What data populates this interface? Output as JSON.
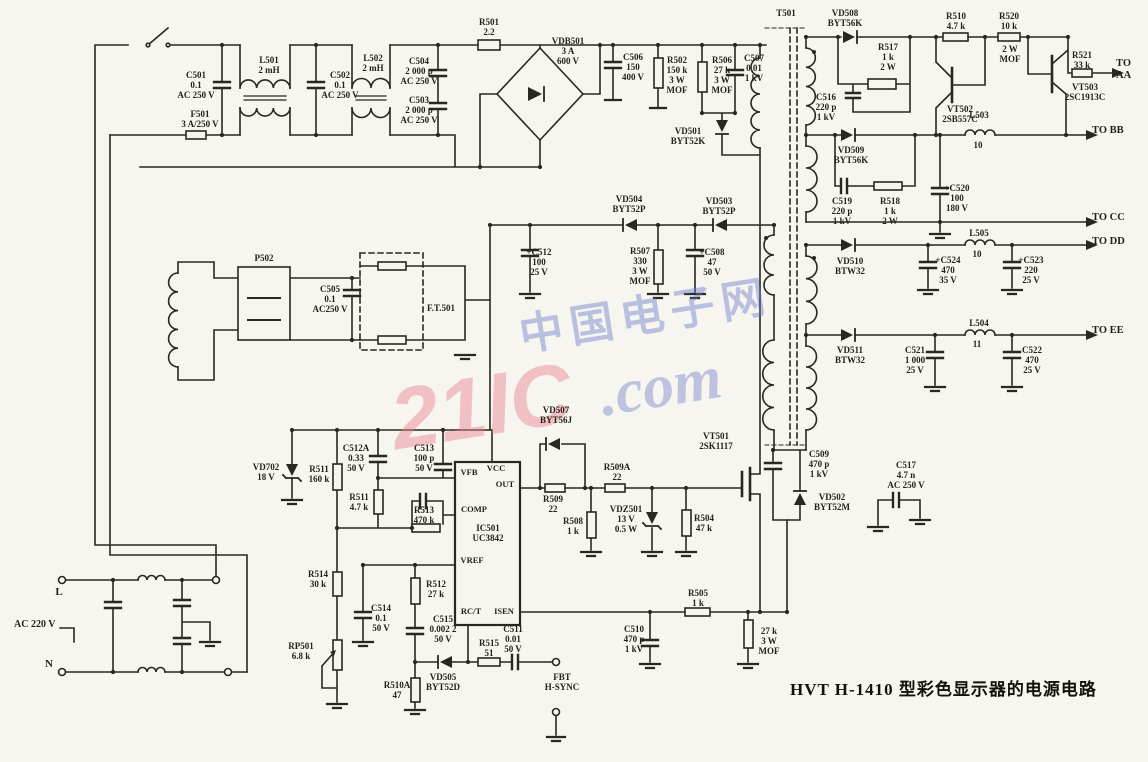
{
  "title": {
    "caption": "HVT H-1410 型彩色显示器的电源电路"
  },
  "watermark": {
    "brand": "21IC",
    "cn": "中国电子网",
    "com": ".com"
  },
  "schematic": {
    "labels": [
      {
        "n": "c501",
        "t": "C501\n0.1\nAC 250 V",
        "x": 196,
        "y": 70
      },
      {
        "n": "f501",
        "t": "F501\n3 A/250 V",
        "x": 200,
        "y": 109
      },
      {
        "n": "l501",
        "t": "L501\n2 mH",
        "x": 269,
        "y": 55
      },
      {
        "n": "c502",
        "t": "C502\n0.1\nAC 250 V",
        "x": 340,
        "y": 70
      },
      {
        "n": "l502",
        "t": "L502\n2 mH",
        "x": 373,
        "y": 53
      },
      {
        "n": "c504",
        "t": "C504\n2 000 p\nAC 250 V",
        "x": 419,
        "y": 56
      },
      {
        "n": "c503",
        "t": "C503\n2 000 p\nAC 250 V",
        "x": 419,
        "y": 95
      },
      {
        "n": "r501",
        "t": "R501\n2.2",
        "x": 489,
        "y": 17
      },
      {
        "n": "vdb501",
        "t": "VDB501\n3 A\n600 V",
        "x": 568,
        "y": 36
      },
      {
        "n": "c506",
        "t": "C506\n150\n400 V",
        "x": 633,
        "y": 52
      },
      {
        "n": "r502",
        "t": "R502\n150 k\n3 W\nMOF",
        "x": 677,
        "y": 55
      },
      {
        "n": "r506",
        "t": "R506\n27 k\n3 W\nMOF",
        "x": 722,
        "y": 55
      },
      {
        "n": "c507",
        "t": "C507\n0.01\n1 kV",
        "x": 754,
        "y": 53
      },
      {
        "n": "vd501",
        "t": "VD501\nBYT52K",
        "x": 688,
        "y": 126
      },
      {
        "n": "t501",
        "t": "T501",
        "x": 786,
        "y": 8
      },
      {
        "n": "vd508",
        "t": "VD508\nBYT56K",
        "x": 845,
        "y": 8
      },
      {
        "n": "r510",
        "t": "R510\n4.7 k",
        "x": 956,
        "y": 11
      },
      {
        "n": "r520",
        "t": "R520\n10 k",
        "x": 1009,
        "y": 11
      },
      {
        "n": "r520-rating",
        "t": "2 W\nMOF",
        "x": 1010,
        "y": 44
      },
      {
        "n": "r517",
        "t": "R517\n1 k\n2 W",
        "x": 888,
        "y": 42
      },
      {
        "n": "c516",
        "t": "C516\n220 p\n1 kV",
        "x": 826,
        "y": 92
      },
      {
        "n": "vt502",
        "t": "VT502\n2SB557C",
        "x": 960,
        "y": 104
      },
      {
        "n": "r521",
        "t": "R521\n33 k",
        "x": 1082,
        "y": 50
      },
      {
        "n": "to-aa",
        "t": "TO AA",
        "x": 1116,
        "y": 58,
        "a": "l",
        "s": 10.5
      },
      {
        "n": "vt503",
        "t": "VT503\n2SC1913C",
        "x": 1085,
        "y": 82
      },
      {
        "n": "l503",
        "t": "L503",
        "x": 979,
        "y": 110
      },
      {
        "n": "l503-val",
        "t": "10",
        "x": 978,
        "y": 140
      },
      {
        "n": "to-bb",
        "t": "TO BB",
        "x": 1092,
        "y": 125,
        "a": "l",
        "s": 10.5
      },
      {
        "n": "vd509",
        "t": "VD509\nBYT56K",
        "x": 851,
        "y": 145
      },
      {
        "n": "c519",
        "t": "C519\n220 p\n1 kV",
        "x": 842,
        "y": 196
      },
      {
        "n": "r518",
        "t": "R518\n1 k\n2 W",
        "x": 890,
        "y": 196
      },
      {
        "n": "c520",
        "t": "+C520\n100\n180 V",
        "x": 957,
        "y": 183
      },
      {
        "n": "to-cc",
        "t": "TO CC",
        "x": 1092,
        "y": 212,
        "a": "l",
        "s": 10.5
      },
      {
        "n": "l505",
        "t": "L505",
        "x": 979,
        "y": 228
      },
      {
        "n": "l505-val",
        "t": "10",
        "x": 977,
        "y": 249
      },
      {
        "n": "to-dd",
        "t": "TO DD",
        "x": 1092,
        "y": 236,
        "a": "l",
        "s": 10.5
      },
      {
        "n": "vd510",
        "t": "VD510\nBTW32",
        "x": 850,
        "y": 256
      },
      {
        "n": "c524",
        "t": "+C524\n470\n35 V",
        "x": 948,
        "y": 255
      },
      {
        "n": "c523",
        "t": "+C523\n220\n25 V",
        "x": 1031,
        "y": 255
      },
      {
        "n": "l504",
        "t": "L504",
        "x": 979,
        "y": 318
      },
      {
        "n": "l504-val",
        "t": "11",
        "x": 977,
        "y": 339
      },
      {
        "n": "to-ee",
        "t": "TO EE",
        "x": 1092,
        "y": 325,
        "a": "l",
        "s": 10.5
      },
      {
        "n": "vd511",
        "t": "VD511\nBTW32",
        "x": 850,
        "y": 345
      },
      {
        "n": "c521",
        "t": "C521\n1 000\n25 V",
        "x": 915,
        "y": 345
      },
      {
        "n": "c522",
        "t": "C522\n470\n25 V",
        "x": 1032,
        "y": 345
      },
      {
        "n": "p502",
        "t": "P502",
        "x": 264,
        "y": 253
      },
      {
        "n": "c505",
        "t": "C505\n0.1\nAC250 V",
        "x": 330,
        "y": 284
      },
      {
        "n": "ft501",
        "t": "F.T.501",
        "x": 427,
        "y": 303,
        "a": "l"
      },
      {
        "n": "vd504",
        "t": "VD504\nBYT52P",
        "x": 629,
        "y": 194
      },
      {
        "n": "vd503",
        "t": "VD503\nBYT52P",
        "x": 719,
        "y": 196
      },
      {
        "n": "c512",
        "t": "+C512\n100\n25 V",
        "x": 539,
        "y": 247
      },
      {
        "n": "r507",
        "t": "R507\n330\n3 W\nMOF",
        "x": 640,
        "y": 246
      },
      {
        "n": "c508",
        "t": "+C508\n47\n50 V",
        "x": 712,
        "y": 247
      },
      {
        "n": "vd702",
        "t": "VD702\n18 V",
        "x": 266,
        "y": 462
      },
      {
        "n": "r511",
        "t": "R511\n160 k",
        "x": 319,
        "y": 464
      },
      {
        "n": "c512a",
        "t": "C512A\n0.33\n50 V",
        "x": 356,
        "y": 443
      },
      {
        "n": "r511b",
        "t": "R511\n4.7 k",
        "x": 359,
        "y": 492
      },
      {
        "n": "r513",
        "t": "R513\n470 k",
        "x": 424,
        "y": 505
      },
      {
        "n": "c513",
        "t": "C513\n100 p\n50 V",
        "x": 424,
        "y": 443
      },
      {
        "n": "r514",
        "t": "R514\n30 k",
        "x": 318,
        "y": 569
      },
      {
        "n": "r512",
        "t": "R512\n27 k",
        "x": 436,
        "y": 579
      },
      {
        "n": "c514",
        "t": "C514\n0.1\n50 V",
        "x": 381,
        "y": 603
      },
      {
        "n": "c515",
        "t": "C515\n0.002 2\n50 V",
        "x": 443,
        "y": 614
      },
      {
        "n": "rp501",
        "t": "RP501\n6.8 k",
        "x": 301,
        "y": 641
      },
      {
        "n": "r515",
        "t": "R515\n51",
        "x": 489,
        "y": 638
      },
      {
        "n": "c511",
        "t": "C511\n0.01\n50 V",
        "x": 513,
        "y": 624
      },
      {
        "n": "fbt",
        "t": "FBT\nH-SYNC",
        "x": 562,
        "y": 672
      },
      {
        "n": "vd505",
        "t": "VD505\nBYT52D",
        "x": 443,
        "y": 672
      },
      {
        "n": "r510a",
        "t": "R510A\n47",
        "x": 397,
        "y": 680
      },
      {
        "n": "ic501",
        "t": "IC501\nUC3842",
        "x": 488,
        "y": 523
      },
      {
        "n": "pin-vfb",
        "t": "VFB",
        "x": 469,
        "y": 468,
        "s": 8.5
      },
      {
        "n": "pin-vcc",
        "t": "VCC",
        "x": 496,
        "y": 464,
        "s": 8.5
      },
      {
        "n": "pin-out",
        "t": "OUT",
        "x": 505,
        "y": 480,
        "s": 8.5
      },
      {
        "n": "pin-comp",
        "t": "COMP",
        "x": 474,
        "y": 505,
        "s": 8.5
      },
      {
        "n": "pin-vref",
        "t": "VREF",
        "x": 472,
        "y": 556,
        "s": 8.5
      },
      {
        "n": "pin-rct",
        "t": "RC/T",
        "x": 471,
        "y": 607,
        "s": 8.5
      },
      {
        "n": "pin-isen",
        "t": "ISEN",
        "x": 504,
        "y": 607,
        "s": 8.5
      },
      {
        "n": "vd507",
        "t": "VD507\nBYT56J",
        "x": 556,
        "y": 405
      },
      {
        "n": "r509",
        "t": "R509\n22",
        "x": 553,
        "y": 494
      },
      {
        "n": "r509a",
        "t": "R509A\n22",
        "x": 617,
        "y": 462
      },
      {
        "n": "r508",
        "t": "R508\n1 k",
        "x": 573,
        "y": 516
      },
      {
        "n": "vdz501",
        "t": "VDZ501\n13 V\n0.5 W",
        "x": 626,
        "y": 504
      },
      {
        "n": "r504",
        "t": "R504\n47 k",
        "x": 704,
        "y": 513
      },
      {
        "n": "vt501",
        "t": "VT501\n2SK1117",
        "x": 716,
        "y": 431
      },
      {
        "n": "c509",
        "t": "C509\n470 p\n1 kV",
        "x": 819,
        "y": 449
      },
      {
        "n": "vd502",
        "t": "VD502\nBYT52M",
        "x": 832,
        "y": 492
      },
      {
        "n": "c517",
        "t": "C517\n4.7 n\nAC 250 V",
        "x": 906,
        "y": 460
      },
      {
        "n": "r505",
        "t": "R505\n1 k",
        "x": 698,
        "y": 588
      },
      {
        "n": "c510",
        "t": "C510\n470 p\n1 kV",
        "x": 634,
        "y": 624
      },
      {
        "n": "r-27k",
        "t": "27 k\n3 W\nMOF",
        "x": 769,
        "y": 626
      },
      {
        "n": "ac-220v",
        "t": "AC 220 V",
        "x": 14,
        "y": 619,
        "a": "l",
        "s": 10
      },
      {
        "n": "term-l",
        "t": "L",
        "x": 59,
        "y": 586,
        "s": 11
      },
      {
        "n": "term-n",
        "t": "N",
        "x": 49,
        "y": 658,
        "s": 11
      }
    ]
  }
}
